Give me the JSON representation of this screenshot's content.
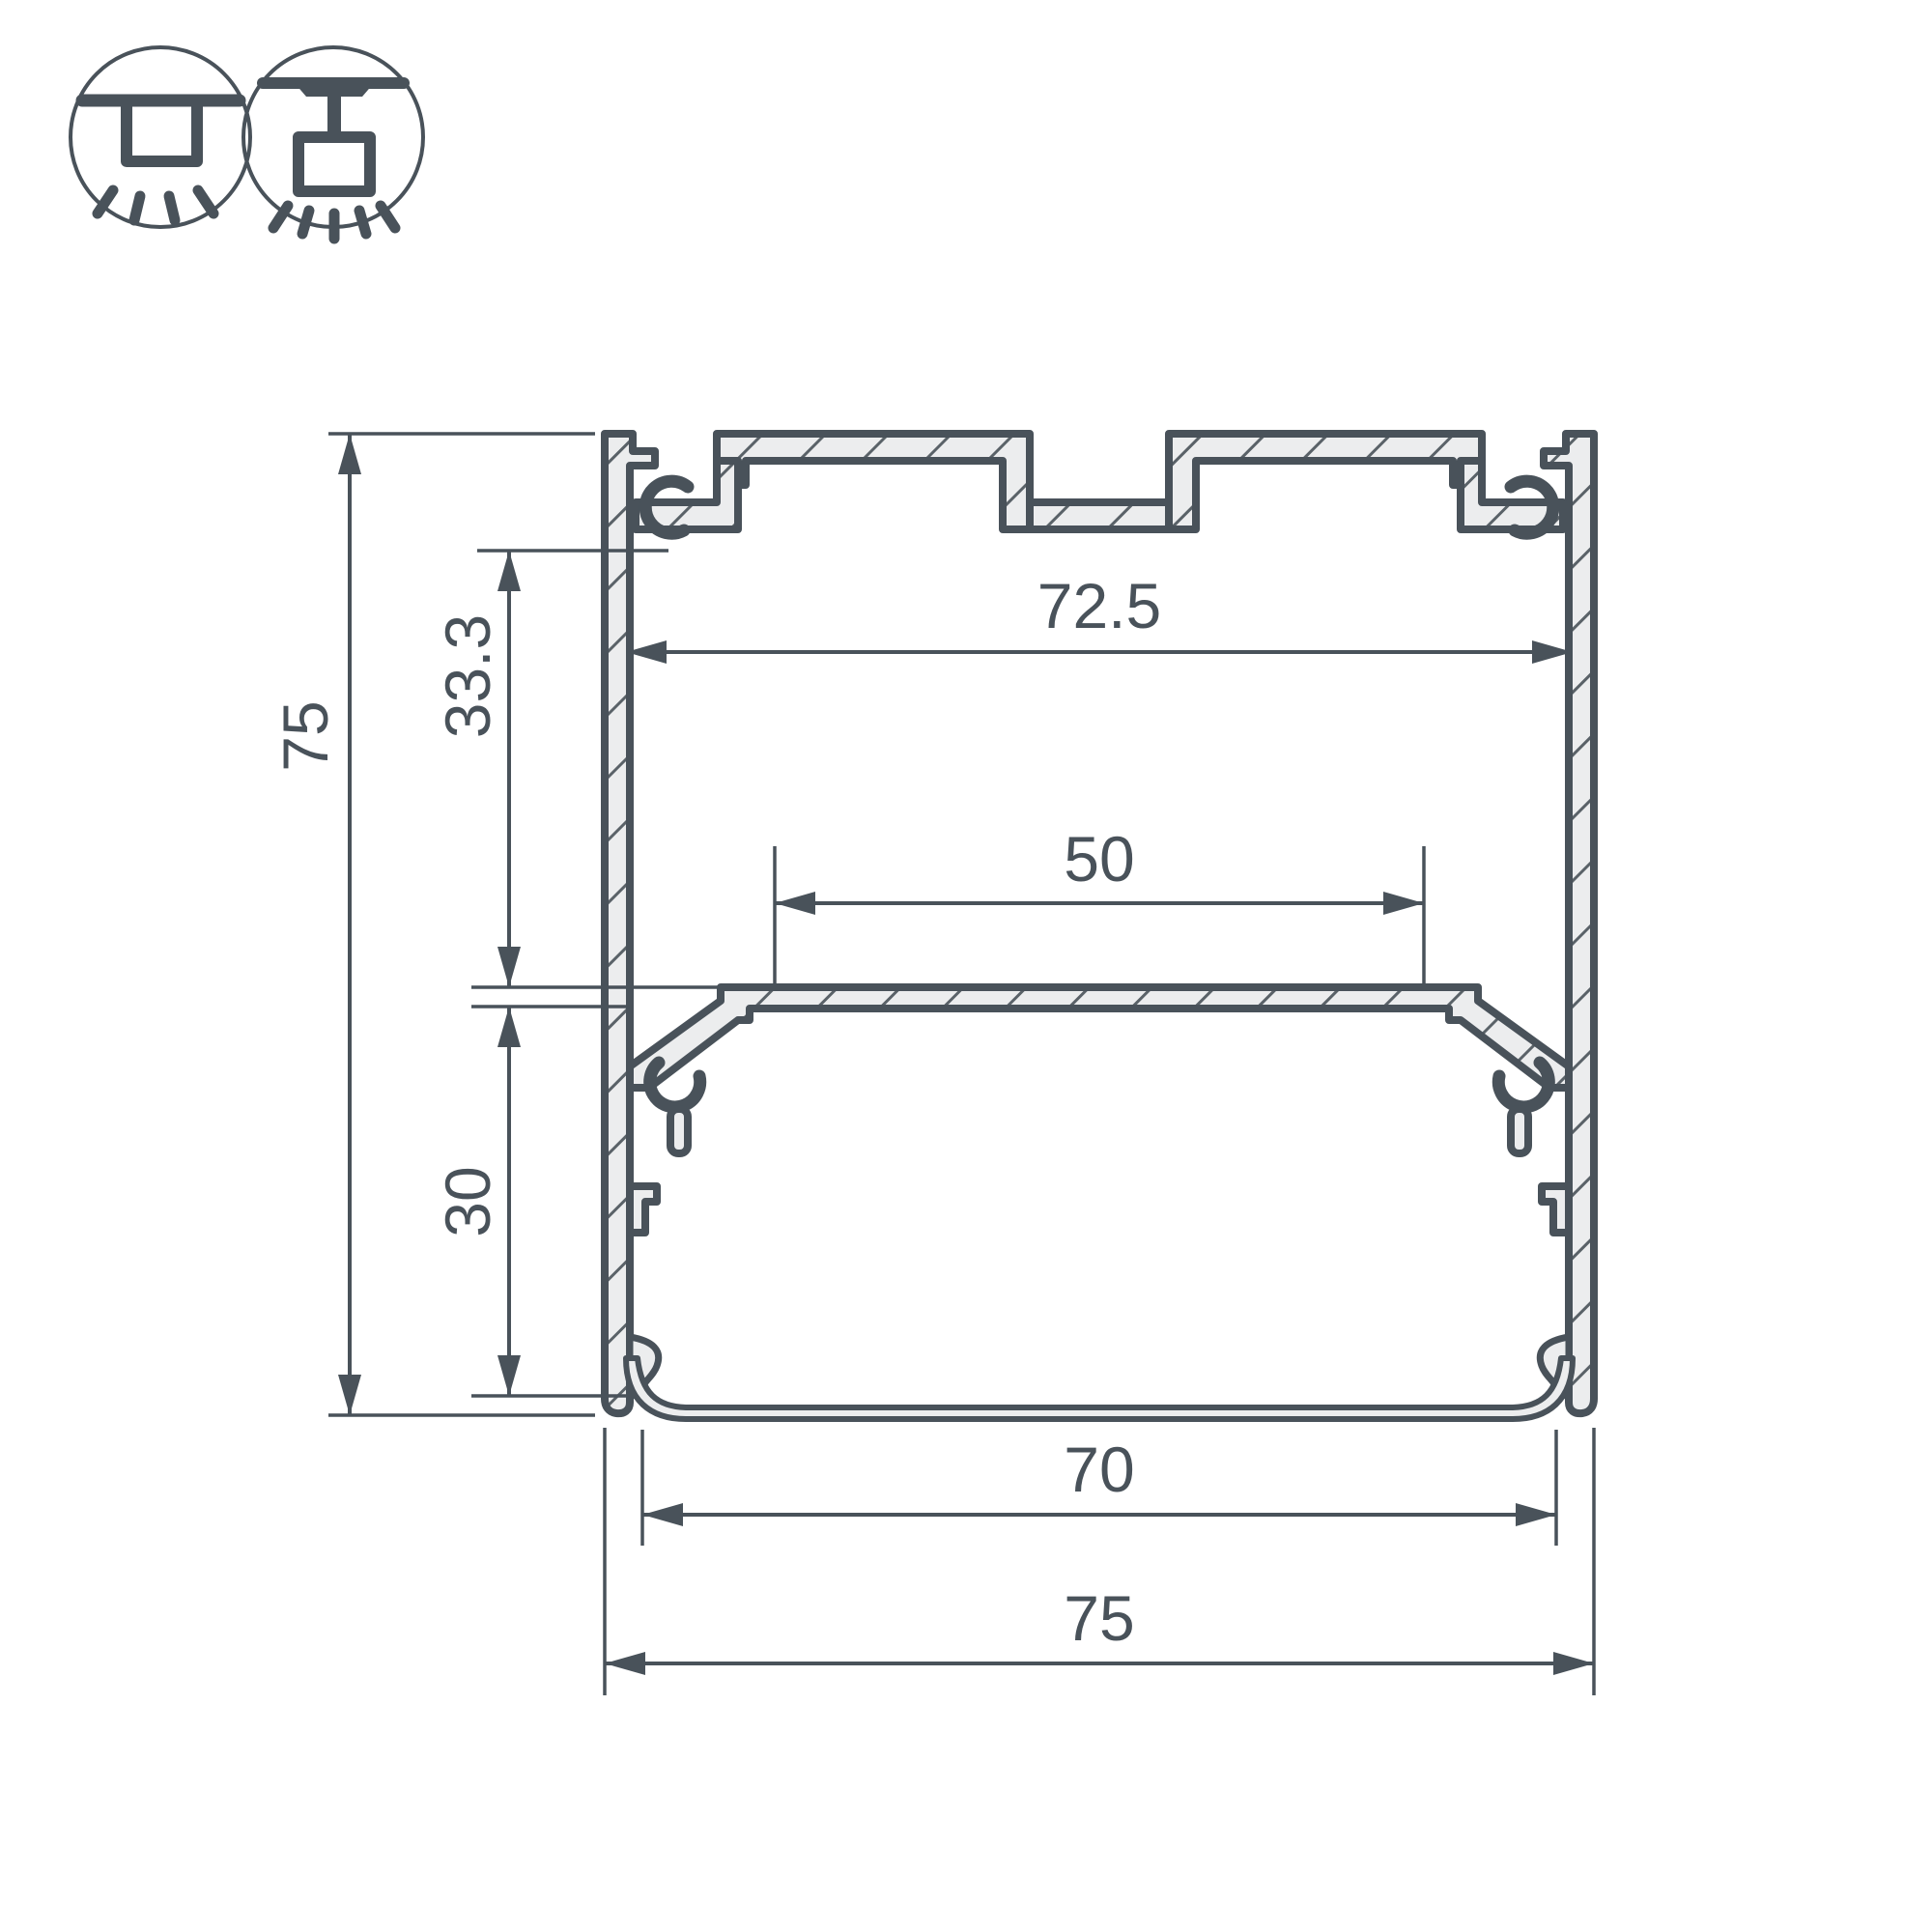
{
  "colors": {
    "background": "#ffffff",
    "line": "#49525a",
    "material_fill": "#ecedee",
    "hatch": "#5a6268"
  },
  "icons": [
    {
      "name": "surface-mount-icon"
    },
    {
      "name": "pendant-mount-icon"
    }
  ],
  "drawing": {
    "type": "led-profile-cross-section",
    "dimensions": {
      "overall_height": "75",
      "inner_top_to_led_shelf": "33.3",
      "led_shelf_to_inner_bottom": "30",
      "inner_width_top": "72.5",
      "led_shelf_flat_width": "50",
      "bottom_opening_width": "70",
      "overall_width": "75"
    }
  }
}
